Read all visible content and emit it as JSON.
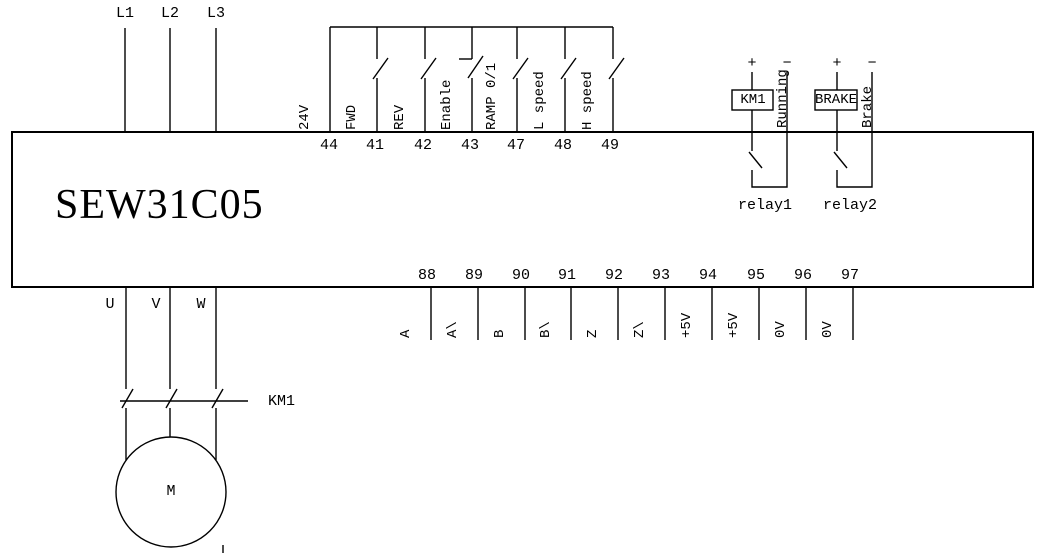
{
  "device": {
    "model": "SEW31C05"
  },
  "power_input": {
    "lines": [
      "L1",
      "L2",
      "L3"
    ]
  },
  "control": {
    "items": [
      {
        "number": "44",
        "label": "24V"
      },
      {
        "number": "41",
        "label": "FWD"
      },
      {
        "number": "42",
        "label": "REV"
      },
      {
        "number": "43",
        "label": "Enable"
      },
      {
        "number": "47",
        "label": "RAMP 0/1"
      },
      {
        "number": "48",
        "label": "L speed"
      },
      {
        "number": "49",
        "label": "H speed"
      }
    ]
  },
  "relays": {
    "relay1": {
      "plus": "+",
      "minus": "−",
      "coil": "KM1",
      "signal": "Running",
      "name": "relay1"
    },
    "relay2": {
      "plus": "+",
      "minus": "−",
      "coil": "BRAKE",
      "signal": "Brake",
      "name": "relay2"
    }
  },
  "encoder": {
    "items": [
      {
        "number": "88",
        "label": "A"
      },
      {
        "number": "89",
        "label": "A\\"
      },
      {
        "number": "90",
        "label": "B"
      },
      {
        "number": "91",
        "label": "B\\"
      },
      {
        "number": "92",
        "label": "Z"
      },
      {
        "number": "93",
        "label": "Z\\"
      },
      {
        "number": "94",
        "label": "+5V"
      },
      {
        "number": "95",
        "label": "+5V"
      },
      {
        "number": "96",
        "label": "0V"
      },
      {
        "number": "97",
        "label": "0V"
      }
    ]
  },
  "motor": {
    "phases": [
      "U",
      "V",
      "W"
    ],
    "contactor": "KM1",
    "symbol": "M"
  },
  "colors": {
    "line": "#000000",
    "background": "#ffffff",
    "text": "#000000"
  }
}
